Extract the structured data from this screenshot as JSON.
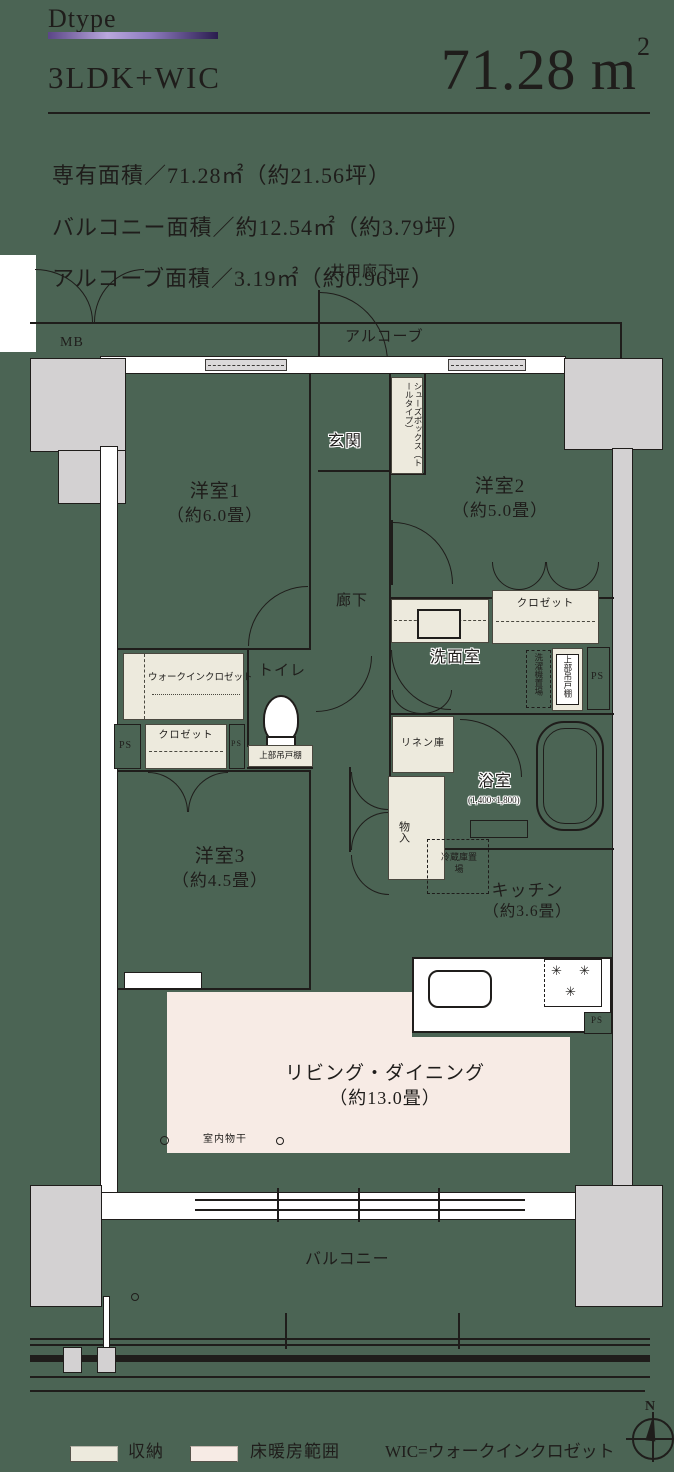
{
  "header": {
    "type_label": "Dtype",
    "layout": "3LDK+WIC",
    "area": {
      "value": "71.28",
      "unit_base": "m",
      "unit_sup": "2"
    },
    "spec_lines": [
      "専有面積／71.28㎡（約21.56坪）",
      "バルコニー面積／約12.54㎡（約3.79坪）",
      "アルコーブ面積／3.19㎡（約0.96坪）"
    ]
  },
  "plan": {
    "common_corridor": "共用廊下",
    "alcove": "アルコーブ",
    "meter_box": "MB",
    "entrance": "玄関",
    "shoe_box": "シューズボックス（トールタイプ）",
    "bedroom1": {
      "name": "洋室1",
      "size": "（約6.0畳）"
    },
    "bedroom2": {
      "name": "洋室2",
      "size": "（約5.0畳）"
    },
    "bedroom3": {
      "name": "洋室3",
      "size": "（約4.5畳）"
    },
    "hallway": "廊下",
    "toilet": "トイレ",
    "washroom": "洗面室",
    "bathroom": {
      "name": "浴室",
      "size": "(1,400×1,800)"
    },
    "kitchen": {
      "name": "キッチン",
      "size": "（約3.6畳）"
    },
    "living_dining": {
      "name": "リビング・ダイニング",
      "size": "（約13.0畳）"
    },
    "balcony": "バルコニー",
    "walk_in_closet": "ウォークインクロゼット",
    "closet": "クロゼット",
    "linen": "リネン庫",
    "storage_small": "物入",
    "upper_cabinet": "上部吊戸棚",
    "washer_space": "洗濯機置場",
    "fridge_space": "冷蔵庫置場",
    "indoor_drying": "室内物干",
    "pipe_space": "PS"
  },
  "legend": {
    "storage": "収納",
    "floor_heating": "床暖房範囲",
    "wic_note": "WIC=ウォークインクロゼット",
    "compass_north": "N"
  },
  "icons": {
    "burner_glyph": "✳"
  },
  "colors": {
    "background": "#4b6454",
    "storage_fill": "#edeadd",
    "floor_heating_fill": "#f7ebe5",
    "column_fill": "#d3d1d2",
    "wall_fill": "#ffffff",
    "line": "#1f1d1b",
    "accent_purple": "#7a5fa8"
  }
}
